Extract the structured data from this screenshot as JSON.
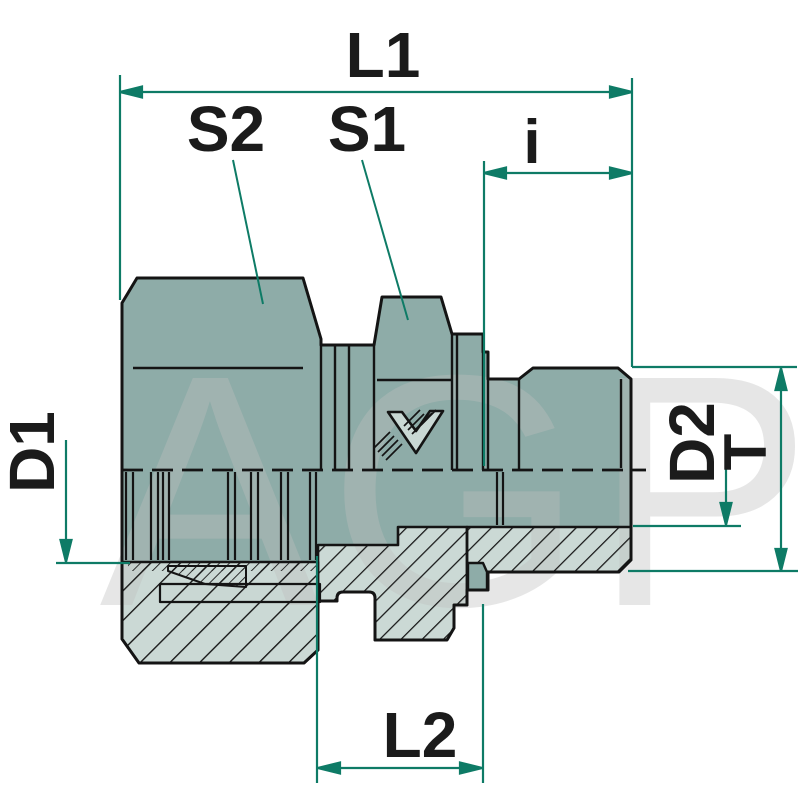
{
  "drawing": {
    "type": "technical-fitting-cross-section",
    "watermark": "AGP",
    "labels": {
      "l1": "L1",
      "s2": "S2",
      "s1": "S1",
      "i": "i",
      "d1": "D1",
      "d2": "D2",
      "t": "T",
      "l2": "L2"
    },
    "colors": {
      "dimension_green": "#0E7B66",
      "body_teal": "#8EACA8",
      "section_light_teal": "#CBD9D5",
      "tube_light": "#C9D7D3",
      "outline_black": "#141414",
      "watermark_gray": "#E3E3E3",
      "background": "#FFFFFF"
    }
  }
}
